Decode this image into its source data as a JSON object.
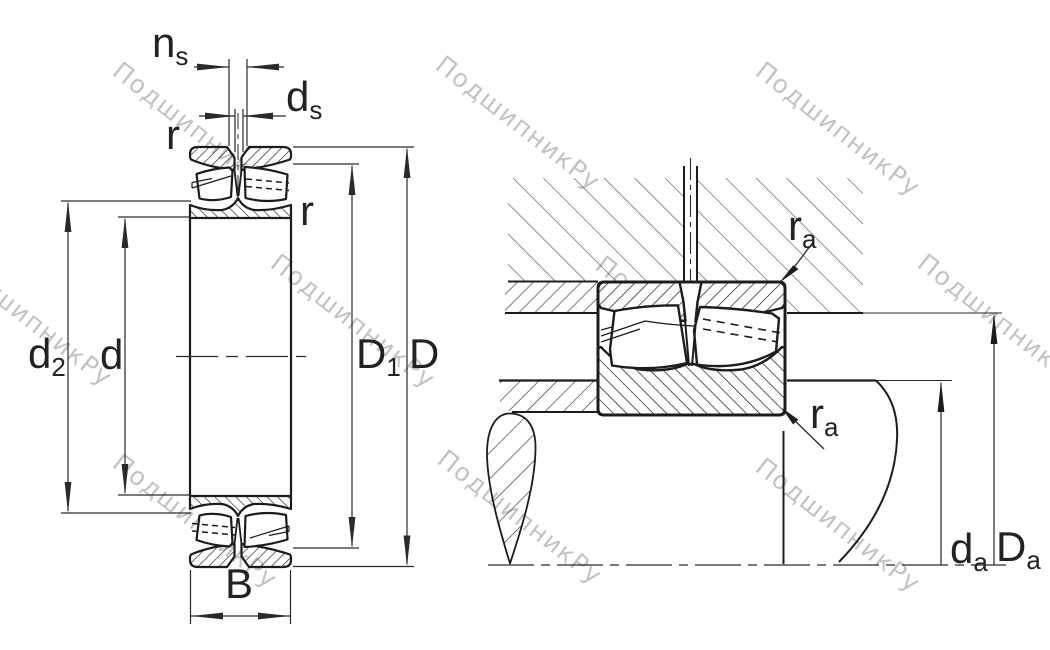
{
  "title": "Spherical roller bearing — section and mounting dimensions drawing",
  "watermark": {
    "text": "ПодшипникРу"
  },
  "labels": {
    "ns": {
      "main": "n",
      "sub": "s"
    },
    "ds": {
      "main": "d",
      "sub": "s"
    },
    "r_outer": {
      "main": "r"
    },
    "r_inner": {
      "main": "r"
    },
    "d2": {
      "main": "d",
      "sub": "2"
    },
    "d": {
      "main": "d"
    },
    "D1": {
      "main": "D",
      "sub": "1"
    },
    "D": {
      "main": "D"
    },
    "B": {
      "main": "B"
    },
    "ra_top": {
      "main": "r",
      "sub": "a"
    },
    "ra_bottom": {
      "main": "r",
      "sub": "a"
    },
    "da": {
      "main": "d",
      "sub": "a"
    },
    "Da": {
      "main": "D",
      "sub": "a"
    }
  }
}
